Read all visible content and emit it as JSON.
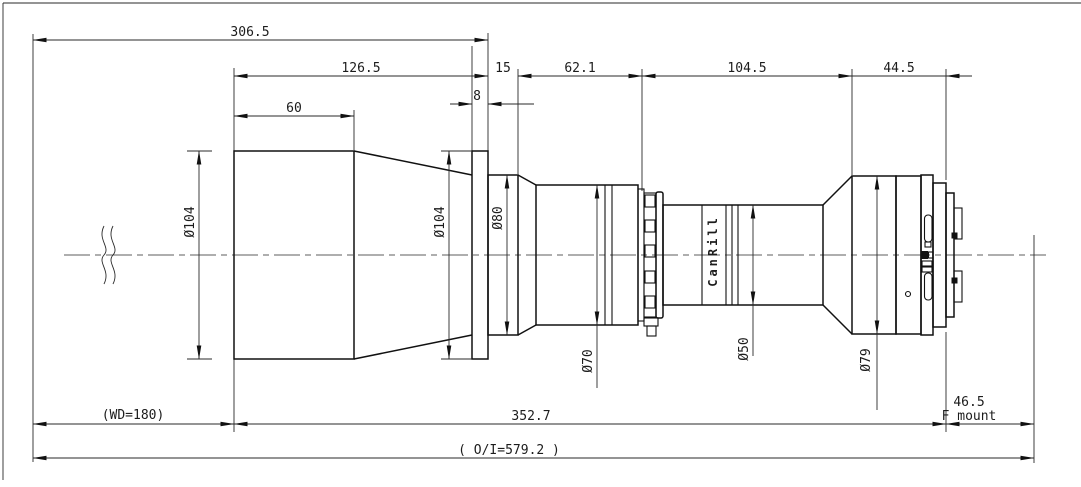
{
  "drawing": {
    "brand_label": "CanRill",
    "dims": {
      "overall_front": "306.5",
      "front_length": "126.5",
      "collar_length": "15",
      "mid_length": "62.1",
      "rear_length": "104.5",
      "mount_length": "44.5",
      "flange_thickness": "8",
      "front_cap": "60",
      "working_distance": "(WD=180)",
      "body_length": "352.7",
      "flange_focal_distance": "46.5",
      "mount_type": "F mount",
      "overall_total": "( O/I=579.2 )"
    },
    "diameters": {
      "front_barrel": "Ø104",
      "flange": "Ø104",
      "collar": "Ø80",
      "focus_barrel": "Ø70",
      "mid_barrel": "Ø50",
      "rear_barrel": "Ø79"
    }
  }
}
